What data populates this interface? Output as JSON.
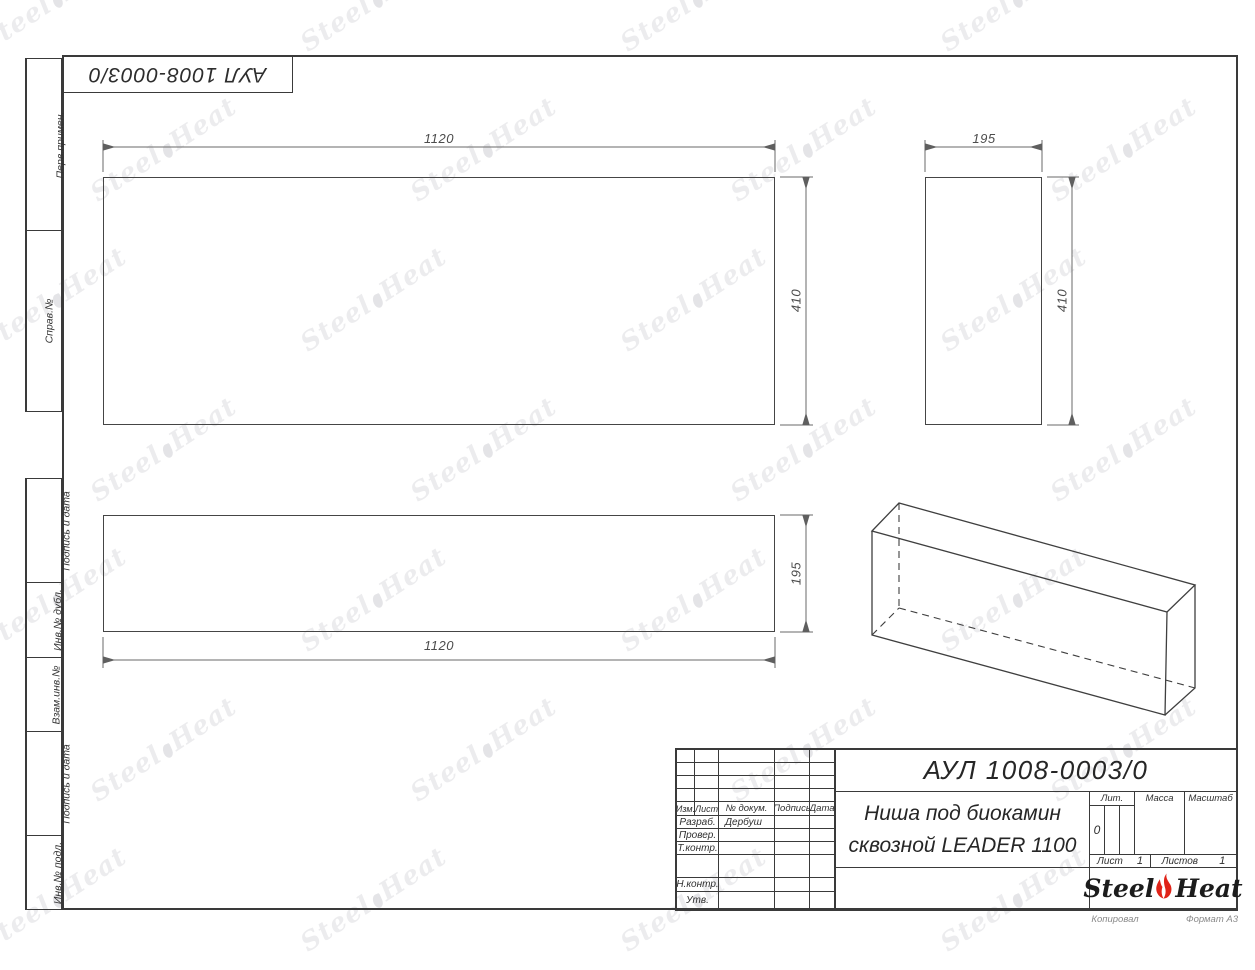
{
  "doc": {
    "number": "АУЛ 1008-0003/0",
    "title_line1": "Ниша под биокамин",
    "title_line2": "сквозной LEADER 1100",
    "copied_label": "Копировал",
    "format_label": "Формат А3"
  },
  "sidebar": {
    "top_sections": [
      {
        "label": "Перв.примен."
      },
      {
        "label": "Справ.№"
      }
    ],
    "bottom_sections": [
      {
        "label": "Подпись и дата"
      },
      {
        "label": "Инв.№ дубл."
      },
      {
        "label": "Взам.инв.№"
      },
      {
        "label": "Подпись и дата"
      },
      {
        "label": "Инв.№ подл."
      }
    ]
  },
  "title_block": {
    "header": {
      "col1": "Изм.",
      "col2": "Лист",
      "col3": "№ докум.",
      "col4": "Подпись",
      "col5": "Дата"
    },
    "rows": [
      {
        "label": "Разраб.",
        "value": "Дербуш"
      },
      {
        "label": "Провер.",
        "value": ""
      },
      {
        "label": "Т.контр.",
        "value": ""
      },
      {
        "label": "Н.контр.",
        "value": ""
      },
      {
        "label": "Утв.",
        "value": ""
      }
    ],
    "lit_label": "Лит.",
    "lit_value": "0",
    "mass_label": "Масса",
    "scale_label": "Масштаб",
    "sheet_label": "Лист",
    "sheet_number": "1",
    "sheets_label": "Листов",
    "sheets_total": "1"
  },
  "logo": {
    "word1": "Steel",
    "word2": "Heat",
    "flame_color": "#e02318"
  },
  "watermark": {
    "word1": "Steel",
    "word2": "Heat"
  },
  "dimensions": {
    "front_width": "1120",
    "front_height": "410",
    "side_width": "195",
    "side_height": "410",
    "top_width": "1120",
    "top_depth": "195"
  },
  "colors": {
    "line": "#3a3a3a",
    "dim_text": "#4c4c4c",
    "flame": "#e02318"
  }
}
